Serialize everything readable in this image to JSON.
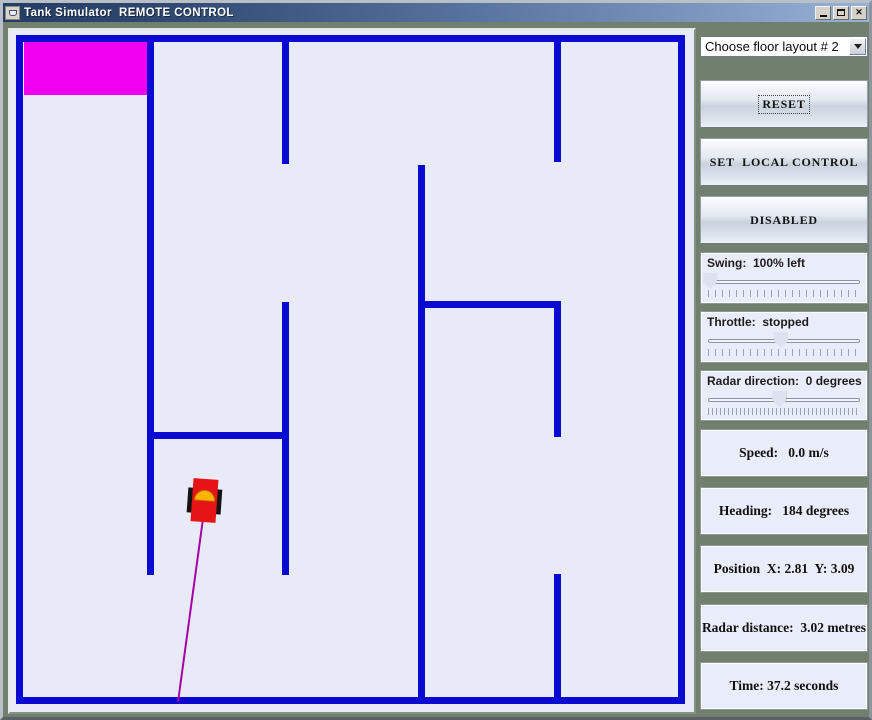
{
  "window": {
    "title": "Tank Simulator  REMOTE CONTROL",
    "controls": {
      "minimize": "minimize",
      "maximize": "maximize",
      "close": "✕"
    }
  },
  "sidebar": {
    "floor_layout": {
      "value": "Choose floor layout # 2"
    },
    "buttons": [
      {
        "label": "RESET"
      },
      {
        "label": "SET  LOCAL CONTROL"
      },
      {
        "label": "DISABLED"
      }
    ],
    "sliders": [
      {
        "label": "Swing:  100% left",
        "value_pct": 2,
        "tick_step": 7
      },
      {
        "label": "Throttle:  stopped",
        "value_pct": 48,
        "tick_step": 7
      },
      {
        "label": "Radar direction:  0 degrees",
        "value_pct": 47,
        "tick_step": 4
      }
    ],
    "status": [
      {
        "label": "Speed:   0.0 m/s"
      },
      {
        "label": "Heading:   184 degrees"
      },
      {
        "label": "Position  X: 2.81  Y: 3.09"
      },
      {
        "label": "Radar distance:  3.02 metres"
      },
      {
        "label": "Time: 37.2 seconds"
      }
    ]
  },
  "maze": {
    "background": "#e8ebf7",
    "wall_color": "#0a0ad2",
    "goal": {
      "x": 14,
      "y": 11,
      "w": 124,
      "h": 54,
      "color": "#f000f0"
    },
    "walls": [
      {
        "x": 6,
        "y": 5,
        "w": 669,
        "h": 7
      },
      {
        "x": 6,
        "y": 667,
        "w": 669,
        "h": 7
      },
      {
        "x": 6,
        "y": 5,
        "w": 7,
        "h": 669
      },
      {
        "x": 668,
        "y": 5,
        "w": 7,
        "h": 669
      },
      {
        "x": 137,
        "y": 12,
        "w": 7,
        "h": 533
      },
      {
        "x": 272,
        "y": 12,
        "w": 7,
        "h": 122
      },
      {
        "x": 272,
        "y": 272,
        "w": 7,
        "h": 273
      },
      {
        "x": 137,
        "y": 402,
        "w": 142,
        "h": 7
      },
      {
        "x": 544,
        "y": 12,
        "w": 7,
        "h": 120
      },
      {
        "x": 408,
        "y": 135,
        "w": 7,
        "h": 539
      },
      {
        "x": 408,
        "y": 271,
        "w": 143,
        "h": 7
      },
      {
        "x": 544,
        "y": 278,
        "w": 7,
        "h": 129
      },
      {
        "x": 544,
        "y": 544,
        "w": 7,
        "h": 130
      }
    ],
    "tank": {
      "x": 194.5,
      "y": 470.5,
      "heading_deg": 184,
      "body_color": "#e61414",
      "tread_color": "#141414",
      "turret_color": "#ffb400",
      "turret_edge": "#c87800"
    },
    "radar_line": {
      "x1": 195,
      "y1": 474,
      "x2": 168,
      "y2": 672,
      "color": "#a400a4"
    }
  }
}
